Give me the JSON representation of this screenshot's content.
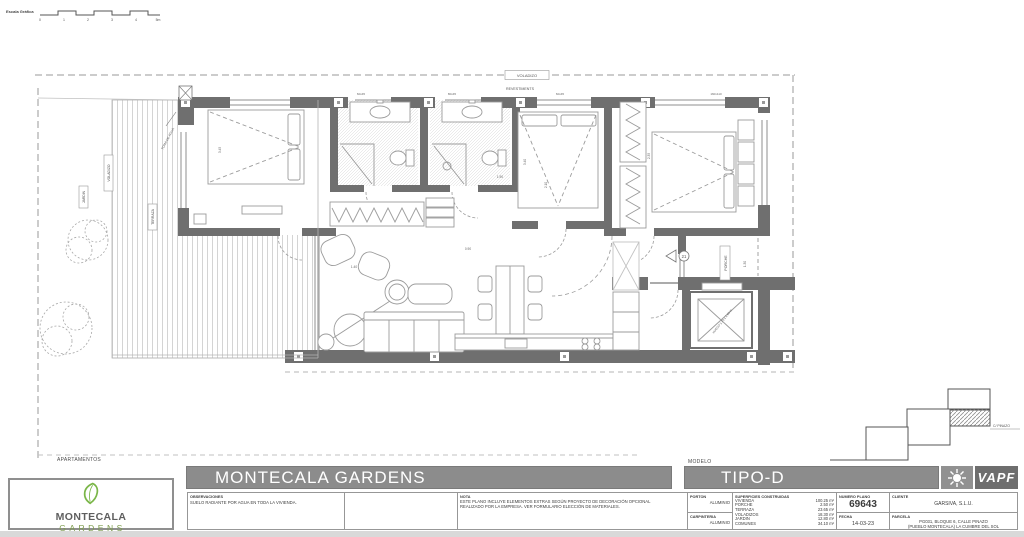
{
  "colors": {
    "wall_gray": "#6f6f6f",
    "bar_gray": "#8c8c8c",
    "logo_green": "#7ab648",
    "line_gray": "#9a9a9a"
  },
  "scale_bar": {
    "label": "Escala Gráfica",
    "ticks": [
      "0",
      "1",
      "2",
      "3",
      "4",
      "5m"
    ]
  },
  "plan": {
    "labels": {
      "voladizo_top": "VOLADIZO",
      "revestiments": "REVESTIMENTS",
      "voladizo_left": "VOLADIZO",
      "jardin": "JARDIN",
      "terraza": "TERRAZA",
      "toma_de_agua": "TOMA DE AGUA",
      "porche": "PORCHE",
      "hueco": "HUECO 1.70 x 1.60 m",
      "door_number": "21"
    },
    "windows": [
      "60x45",
      "80x45",
      "60x45",
      "160x110"
    ],
    "dimensions": [
      "3.45",
      "3.40",
      "2.10",
      "1.40",
      "0.90",
      "2.35",
      "1.30",
      "1.90"
    ]
  },
  "site_key": {
    "street": "C/ PINAZO"
  },
  "title_block": {
    "apartments_label": "APARTAMENTOS",
    "project_title": "MONTECALA GARDENS",
    "model_label": "MODELO",
    "model_value": "TIPO-D",
    "logo": {
      "line1": "MONTECALA",
      "line2": "GARDENS"
    },
    "observaciones": {
      "label": "OBSERVACIONES",
      "text": "SUELO RADIANTE POR AGUA EN TODA LA VIVIENDA."
    },
    "nota": {
      "label": "NOTA",
      "line1": "ESTE PLANO INCLUYE ELEMENTOS EXTRAS SEGÚN PROYECTO DE DECORACIÓN OPCIONAL",
      "line2": "REALIZADO POR LA EMPRESA. VER FORMULARIO ELECCIÓN DE MATERIALES."
    },
    "porton": {
      "label": "PORTON",
      "value": "ALUMINIO"
    },
    "carpinteria": {
      "label": "CARPINTERIA",
      "value": "ALUMINIO"
    },
    "superficies": {
      "label": "SUPERFICIES CONSTRUIDAS",
      "rows": [
        {
          "name": "VIVIENDA",
          "value": "100.25 m²"
        },
        {
          "name": "PORCHE",
          "value": "2.50 m²"
        },
        {
          "name": "TERRAZA",
          "value": "23.65 m²"
        },
        {
          "name": "VOLADIZOS",
          "value": "18.30 m²"
        },
        {
          "name": "JARDIN",
          "value": "12.80 m²"
        },
        {
          "name": "COMUNES",
          "value": "34.10 m²"
        }
      ]
    },
    "numero_plano": {
      "label": "NUMERO PLANO",
      "value": "69643"
    },
    "fecha": {
      "label": "FECHA",
      "value": "14-03-23"
    },
    "cliente": {
      "label": "CLIENTE",
      "value": "GARSIVA, S.L.U."
    },
    "parcela": {
      "label": "PARCELA",
      "line1": "PG031, BLOQUE 6, CALLE PINAZO",
      "line2": "(PUEBLO MONTECALA) LA CUMBRE DEL SOL"
    },
    "vapf": "VAPF"
  }
}
